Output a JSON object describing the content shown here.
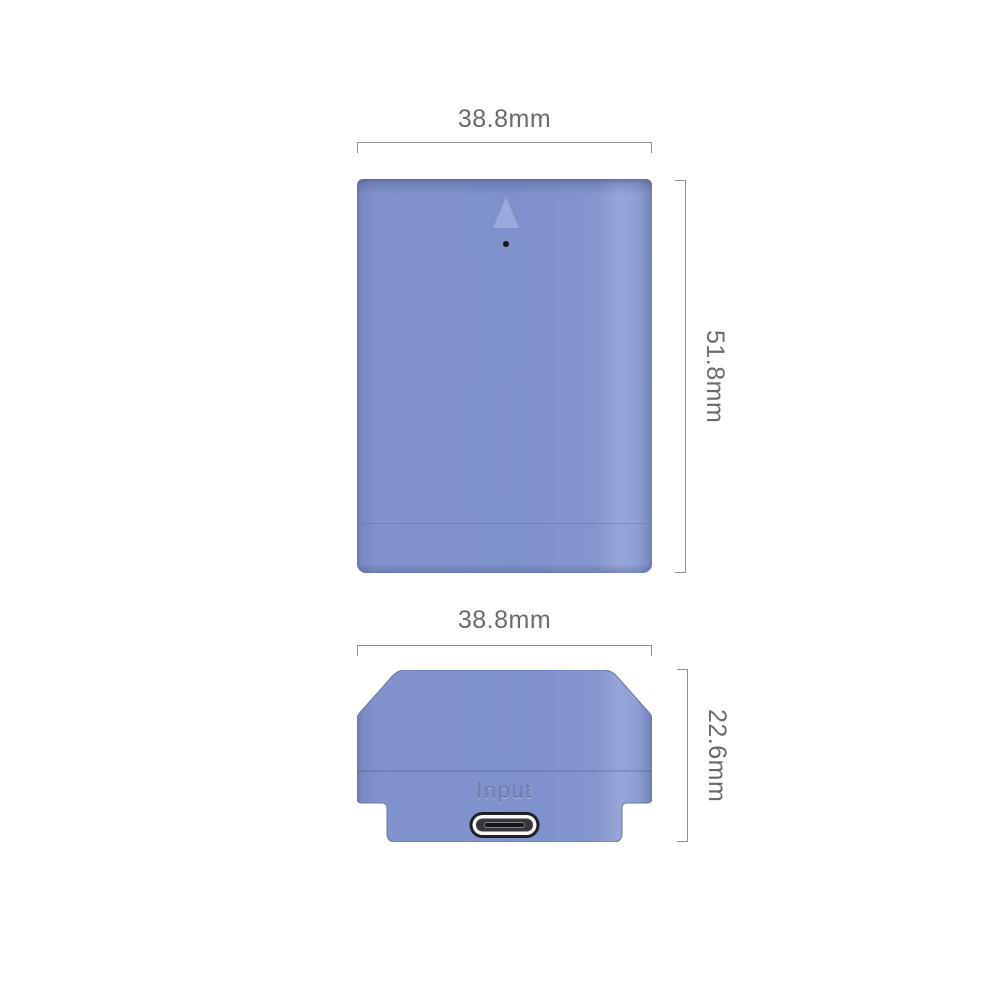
{
  "diagram": {
    "front_view": {
      "width_label": "38.8mm",
      "height_label": "51.8mm"
    },
    "bottom_view": {
      "width_label": "38.8mm",
      "height_label": "22.6mm",
      "port_label": "Input"
    }
  },
  "colors": {
    "background": "#ffffff",
    "battery_body": "#8093cc",
    "battery_highlight": "#96a6d9",
    "battery_edge_dark": "#6c7bb3",
    "battery_top_shadow": "#5e6da9",
    "triangle_marker": "#9aaadc",
    "alignment_dot": "#17171a",
    "dimension_line": "#8f8f8f",
    "dimension_text": "#6a6a6a",
    "input_label_text": "#6070a8",
    "usb_port_ring": "#fafafa",
    "usb_port_body": "#36363c",
    "usb_port_outline": "#1f1f24"
  }
}
